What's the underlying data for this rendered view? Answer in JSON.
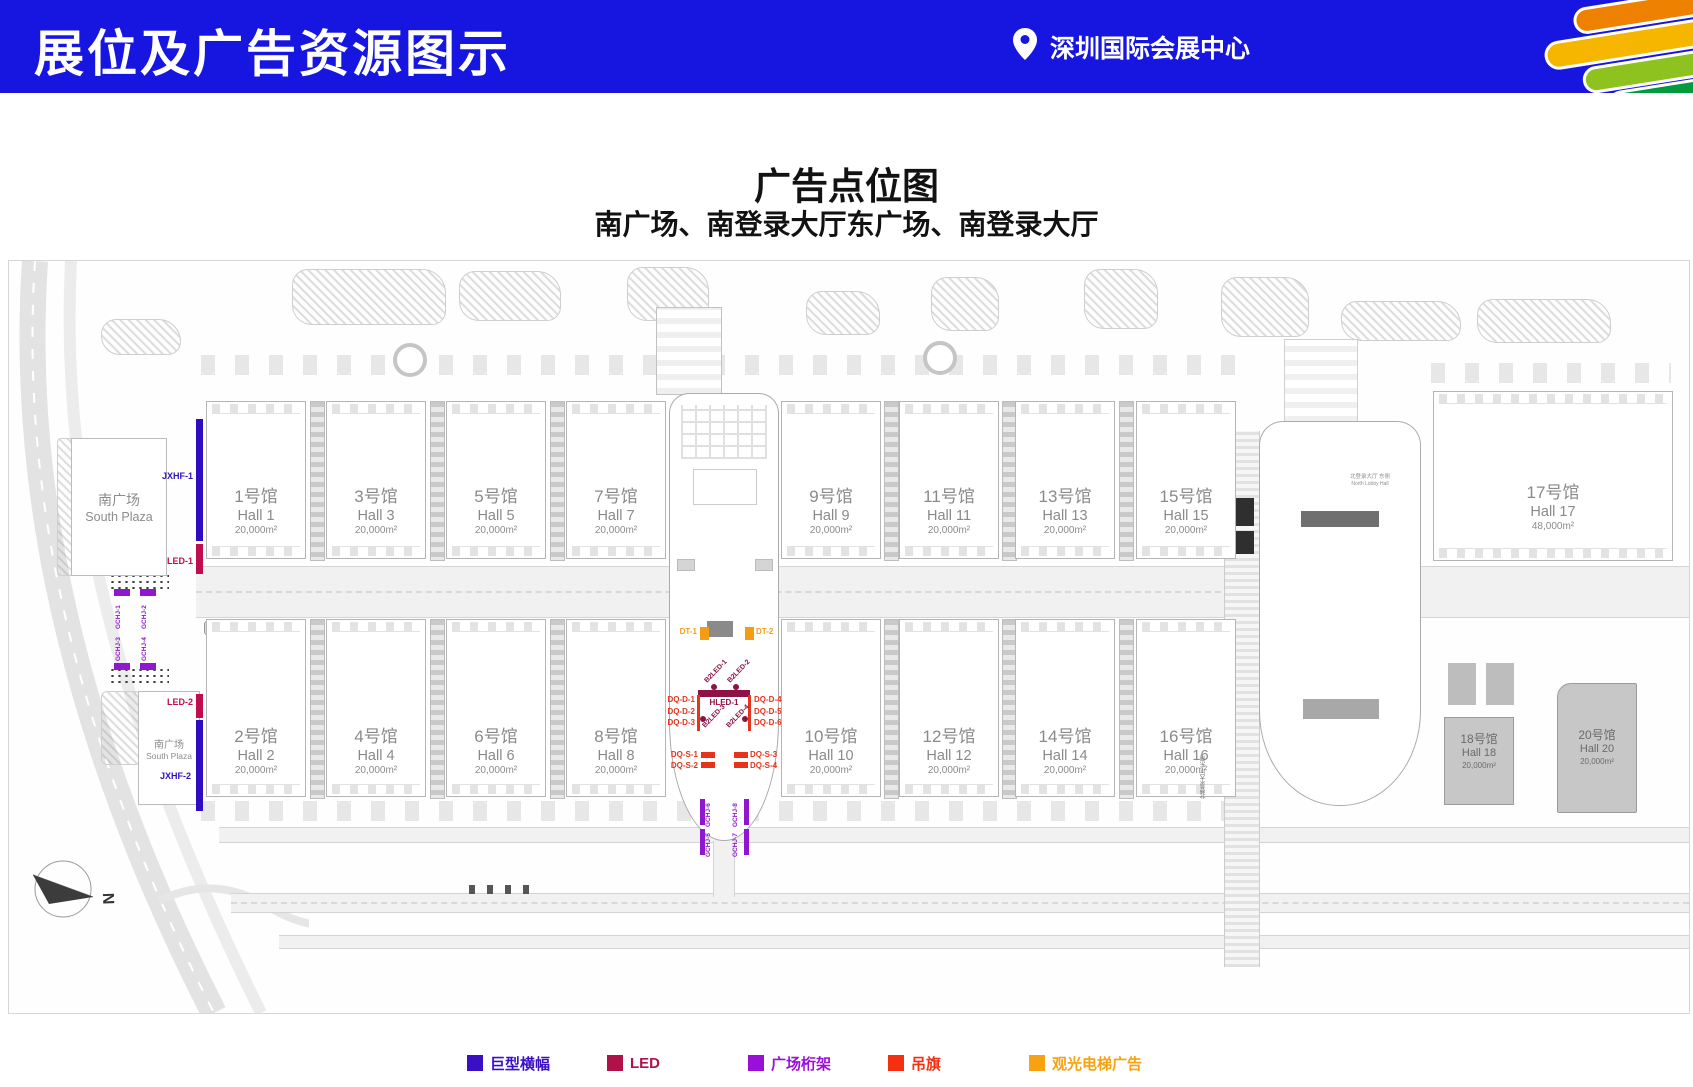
{
  "header": {
    "title": "展位及广告资源图示",
    "location": "深圳国际会展中心"
  },
  "map": {
    "title": "广告点位图",
    "subtitle": "南广场、南登录大厅东广场、南登录大厅",
    "plaza_top": {
      "cn": "南广场",
      "en": "South Plaza"
    },
    "plaza_bottom": {
      "cn": "南广场",
      "en": "South Plaza"
    },
    "north_lobby_label": {
      "cn": "北登录大厅 东侧",
      "en": "North Lobby Hall"
    },
    "north_lobby_side": "北登录大厅 东侧",
    "compass": "N",
    "halls": {
      "h1": {
        "cn": "1号馆",
        "en": "Hall 1",
        "area": "20,000m²"
      },
      "h2": {
        "cn": "2号馆",
        "en": "Hall 2",
        "area": "20,000m²"
      },
      "h3": {
        "cn": "3号馆",
        "en": "Hall 3",
        "area": "20,000m²"
      },
      "h4": {
        "cn": "4号馆",
        "en": "Hall 4",
        "area": "20,000m²"
      },
      "h5": {
        "cn": "5号馆",
        "en": "Hall 5",
        "area": "20,000m²"
      },
      "h6": {
        "cn": "6号馆",
        "en": "Hall 6",
        "area": "20,000m²"
      },
      "h7": {
        "cn": "7号馆",
        "en": "Hall 7",
        "area": "20,000m²"
      },
      "h8": {
        "cn": "8号馆",
        "en": "Hall 8",
        "area": "20,000m²"
      },
      "h9": {
        "cn": "9号馆",
        "en": "Hall 9",
        "area": "20,000m²"
      },
      "h10": {
        "cn": "10号馆",
        "en": "Hall 10",
        "area": "20,000m²"
      },
      "h11": {
        "cn": "11号馆",
        "en": "Hall 11",
        "area": "20,000m²"
      },
      "h12": {
        "cn": "12号馆",
        "en": "Hall 12",
        "area": "20,000m²"
      },
      "h13": {
        "cn": "13号馆",
        "en": "Hall 13",
        "area": "20,000m²"
      },
      "h14": {
        "cn": "14号馆",
        "en": "Hall 14",
        "area": "20,000m²"
      },
      "h15": {
        "cn": "15号馆",
        "en": "Hall 15",
        "area": "20,000m²"
      },
      "h16": {
        "cn": "16号馆",
        "en": "Hall 16",
        "area": "20,000m²"
      },
      "h17": {
        "cn": "17号馆",
        "en": "Hall 17",
        "area": "48,000m²"
      },
      "h18": {
        "cn": "18号馆",
        "en": "Hall 18",
        "area": "20,000m²"
      },
      "h20": {
        "cn": "20号馆",
        "en": "Hall 20",
        "area": "20,000m²"
      }
    },
    "markers": {
      "jxhf1": "JXHF-1",
      "jxhf2": "JXHF-2",
      "led1": "LED-1",
      "led2": "LED-2",
      "gchj1": "GCHJ-1",
      "gchj2": "GCHJ-2",
      "gchj3": "GCHJ-3",
      "gchj4": "GCHJ-4",
      "gchj5": "GCHJ-5",
      "gchj6": "GCHJ-6",
      "gchj7": "GCHJ-7",
      "gchj8": "GCHJ-8",
      "dt1": "DT-1",
      "dt2": "DT-2",
      "hled1": "HLED-1",
      "b2led1": "B2LED-1",
      "b2led2": "B2LED-2",
      "b2led3": "B2LED-3",
      "b2led4": "B2LED-4",
      "dqd1": "DQ-D-1",
      "dqd2": "DQ-D-2",
      "dqd3": "DQ-D-3",
      "dqd4": "DQ-D-4",
      "dqd5": "DQ-D-5",
      "dqd6": "DQ-D-6",
      "dqs1": "DQ-S-1",
      "dqs2": "DQ-S-2",
      "dqs3": "DQ-S-3",
      "dqs4": "DQ-S-4"
    }
  },
  "legend": {
    "items": [
      {
        "label": "巨型横幅",
        "color": "#3a0fc6"
      },
      {
        "label": "LED",
        "color": "#b01148"
      },
      {
        "label": "广场桁架",
        "color": "#9a10d8"
      },
      {
        "label": "吊旗",
        "color": "#f53010"
      },
      {
        "label": "观光电梯广告",
        "color": "#f6a211"
      }
    ]
  }
}
